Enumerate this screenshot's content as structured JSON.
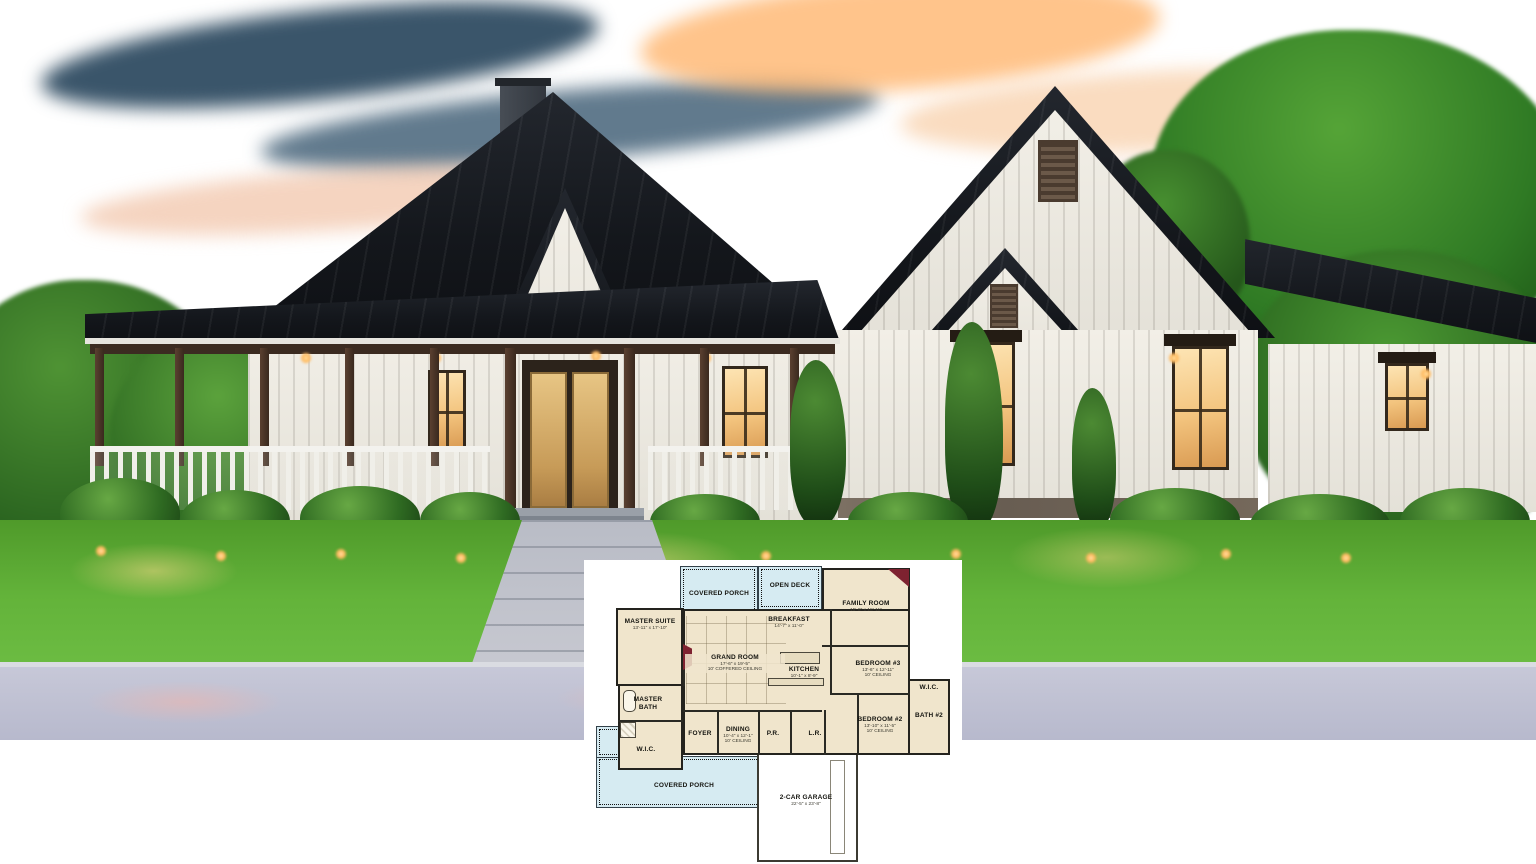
{
  "palette": {
    "sky_dusk_blue": "#3a5d7d",
    "sunset_orange": "#f2a25c",
    "roof_metal_dark": "#14171c",
    "siding_white": "#f2efe7",
    "porch_wood_brown": "#4a3329",
    "window_glow": "#f7d9a0",
    "lawn_green": "#5aa832",
    "driveway_gray": "#c3c4d6",
    "plan_room_fill": "#f0e5cc",
    "plan_porch_fill": "#d6ebf2",
    "plan_wall": "#24231e",
    "plan_fireplace_red": "#7e2230"
  },
  "floor_plan": {
    "rooms": {
      "covered_porch_top": {
        "name": "COVERED PORCH"
      },
      "open_deck": {
        "name": "OPEN DECK"
      },
      "family_room": {
        "name": "FAMILY ROOM",
        "dims": "15'-8\" x 18'-11\""
      },
      "master_suite": {
        "name": "MASTER SUITE",
        "dims": "13'-11\" x 17'-10\""
      },
      "breakfast": {
        "name": "BREAKFAST",
        "dims": "14'-7\" x 11'-0\""
      },
      "grand_room": {
        "name": "GRAND ROOM",
        "dims": "17'-6\" x 19'-5\"",
        "ceiling": "10' COFFERED CEILING"
      },
      "kitchen": {
        "name": "KITCHEN",
        "dims": "10'-1\" x 8'-9\""
      },
      "bedroom_3": {
        "name": "BEDROOM #3",
        "dims": "13'-6\" x 12'-11\"",
        "ceiling": "10' CEILING"
      },
      "wic_right": {
        "name": "W.I.C."
      },
      "bath_2": {
        "name": "BATH #2"
      },
      "bedroom_2": {
        "name": "BEDROOM #2",
        "dims": "13'-10\" x 11'-5\"",
        "ceiling": "10' CEILING"
      },
      "master_bath": {
        "name": "MASTER BATH"
      },
      "foyer": {
        "name": "FOYER"
      },
      "dining": {
        "name": "DINING",
        "dims": "10'-4\" x 12'-1\"",
        "ceiling": "10' CEILING"
      },
      "pr": {
        "name": "P.R."
      },
      "lr": {
        "name": "L.R."
      },
      "wic_left": {
        "name": "W.I.C."
      },
      "covered_porch_bottom": {
        "name": "COVERED PORCH"
      },
      "garage": {
        "name": "2-CAR GARAGE",
        "dims": "22'-5\" x 23'-8\""
      }
    }
  }
}
